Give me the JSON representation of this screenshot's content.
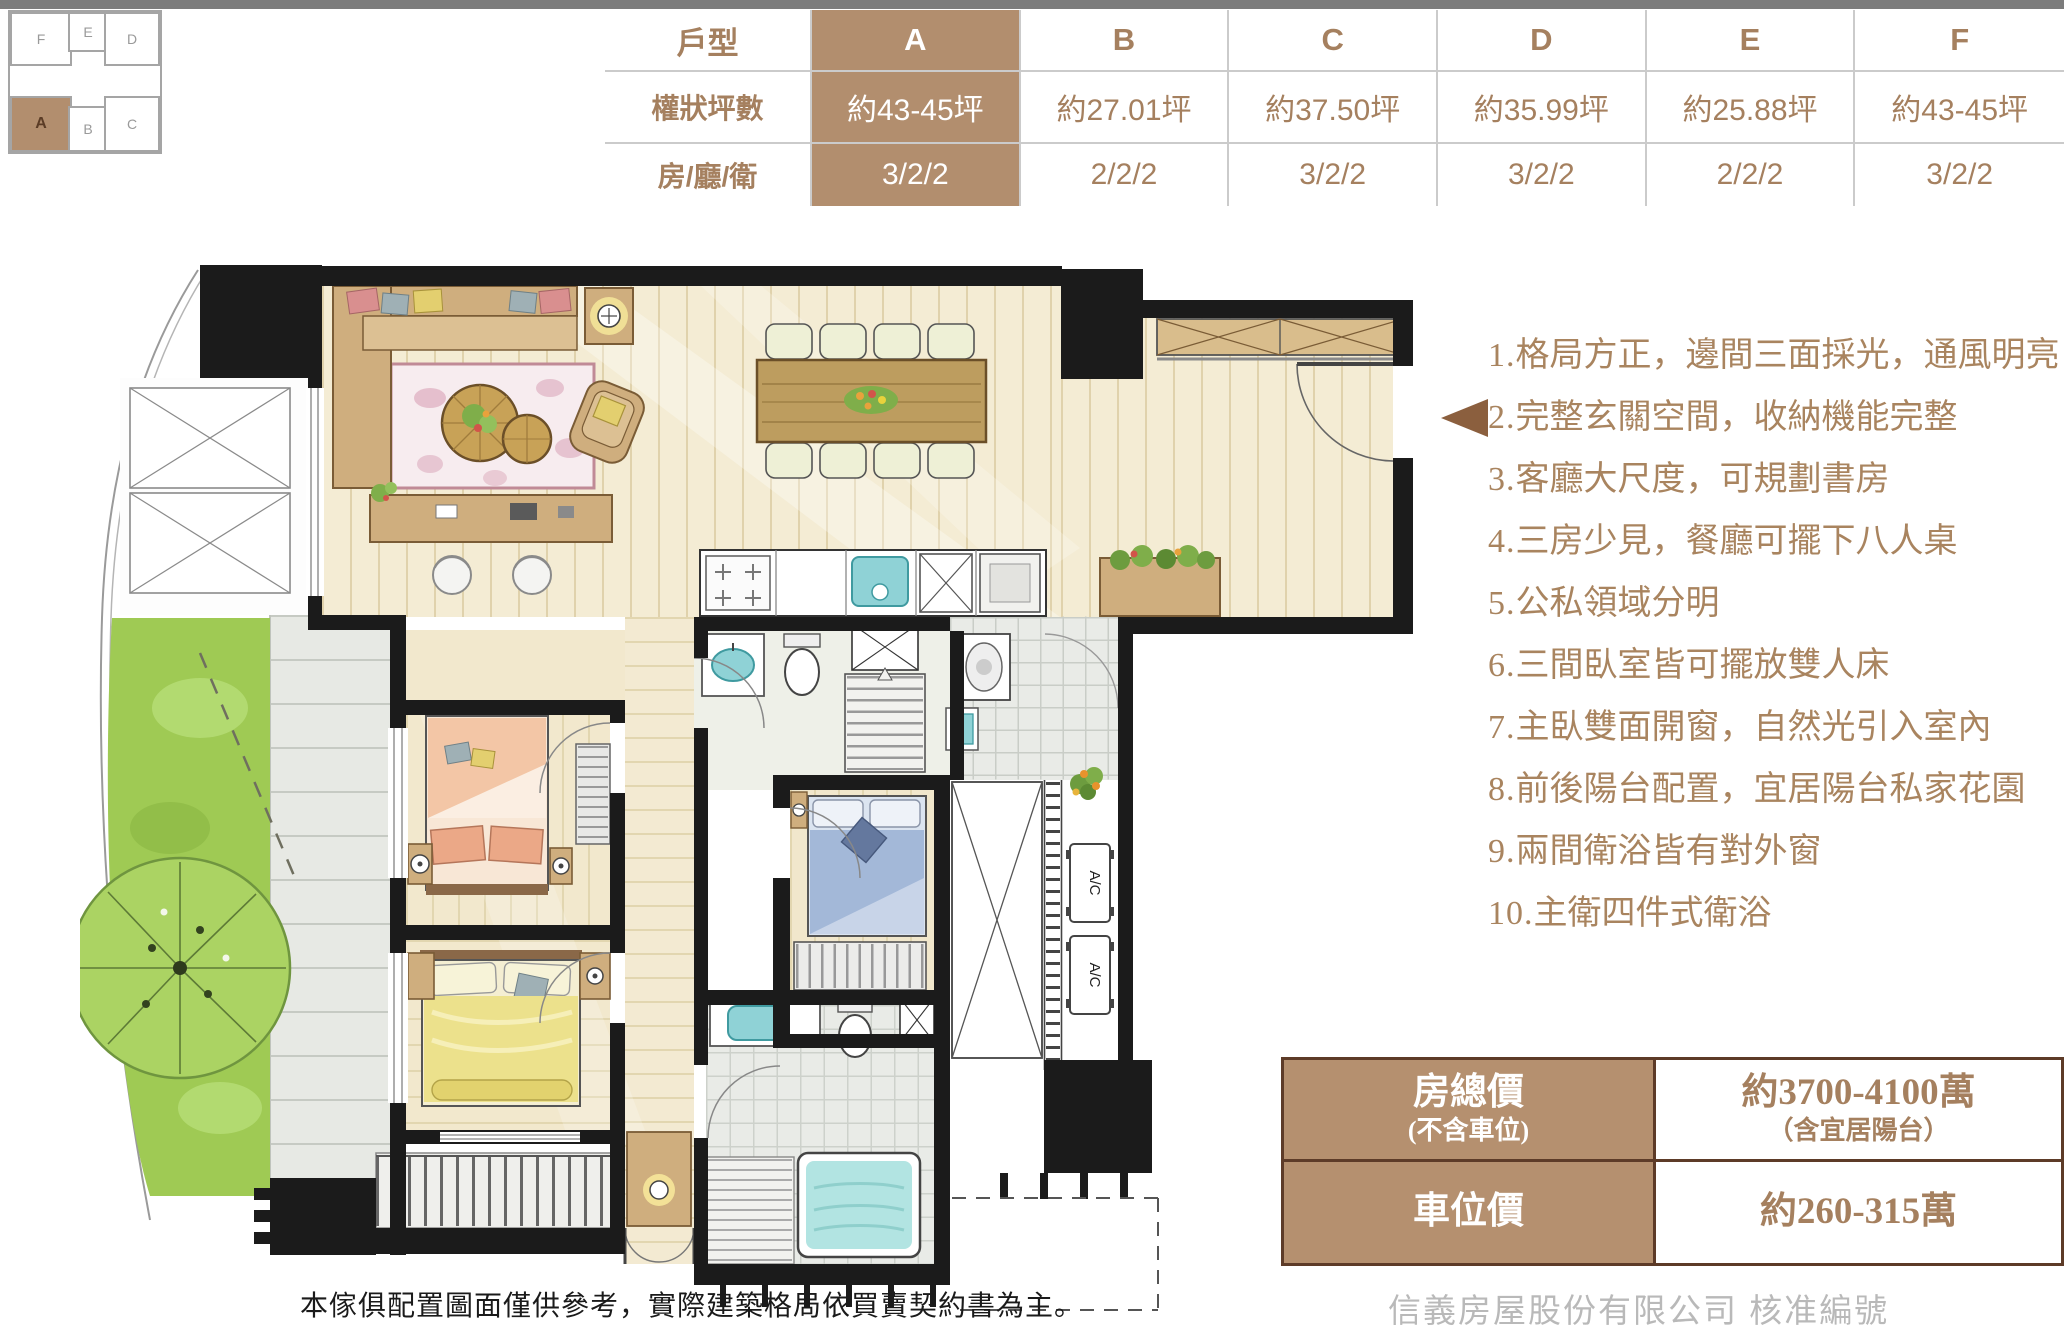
{
  "page": {
    "top_bar_color": "#7c7c7c",
    "background": "#ffffff"
  },
  "unit_diagram": {
    "cells": [
      {
        "label": "F"
      },
      {
        "label": "E"
      },
      {
        "label": "D"
      },
      {
        "label": "A"
      },
      {
        "label": "B"
      },
      {
        "label": "C"
      }
    ],
    "highlighted_unit": "A",
    "highlight_color": "#b28e6e"
  },
  "spec_table": {
    "header_label": "戶型",
    "columns": [
      "A",
      "B",
      "C",
      "D",
      "E",
      "F"
    ],
    "highlight_column": "A",
    "rows": [
      {
        "label": "權狀坪數",
        "values": [
          "約43-45坪",
          "約27.01坪",
          "約37.50坪",
          "約35.99坪",
          "約25.88坪",
          "約43-45坪"
        ]
      },
      {
        "label": "房/廳/衛",
        "values": [
          "3/2/2",
          "2/2/2",
          "3/2/2",
          "3/2/2",
          "2/2/2",
          "3/2/2"
        ]
      }
    ],
    "colors": {
      "highlight_bg": "#b28e6e",
      "text": "#a5805f",
      "border": "#cbcbcb"
    }
  },
  "features": {
    "items": [
      {
        "num": "1.",
        "text": "格局方正，邊間三面採光，通風明亮"
      },
      {
        "num": "2.",
        "text": "完整玄關空間，收納機能完整"
      },
      {
        "num": "3.",
        "text": "客廳大尺度，可規劃書房"
      },
      {
        "num": "4.",
        "text": "三房少見，餐廳可擺下八人桌"
      },
      {
        "num": "5.",
        "text": "公私領域分明"
      },
      {
        "num": "6.",
        "text": "三間臥室皆可擺放雙人床"
      },
      {
        "num": "7.",
        "text": "主臥雙面開窗，自然光引入室內"
      },
      {
        "num": "8.",
        "text": "前後陽台配置，宜居陽台私家花園"
      },
      {
        "num": "9.",
        "text": "兩間衛浴皆有對外窗"
      },
      {
        "num": "10.",
        "text": "主衛四件式衛浴"
      }
    ],
    "arrow_color": "#8b5f3e"
  },
  "price_table": {
    "rows": [
      {
        "label": "房總價",
        "label_note": "(不含車位)",
        "value": "約3700-4100萬",
        "value_note": "（含宜居陽台）"
      },
      {
        "label": "車位價",
        "label_note": "",
        "value": "約260-315萬",
        "value_note": ""
      }
    ],
    "colors": {
      "label_bg": "#b5906f",
      "border": "#5d3b28",
      "value_text": "#a5805f"
    }
  },
  "footer": {
    "disclaimer": "本傢俱配置圖面僅供參考，實際建築格局依買賣契約書為主。",
    "watermark": "信義房屋股份有限公司  核准編號 3865200338"
  },
  "floor_plan": {
    "ac_label": "A/C",
    "palette": {
      "wall": "#1b1b1b",
      "wood_floor": "#f4ecd4",
      "furniture_wood": "#cfae7e",
      "rug": "#f7ecef",
      "lawn": "#9fca54",
      "tile": "#e9ebe7",
      "bed_peach": "#f3c6a6",
      "bed_yellow": "#ece18c",
      "bed_blue": "#a3b8d8",
      "tub_water": "#b2e4e2"
    }
  }
}
